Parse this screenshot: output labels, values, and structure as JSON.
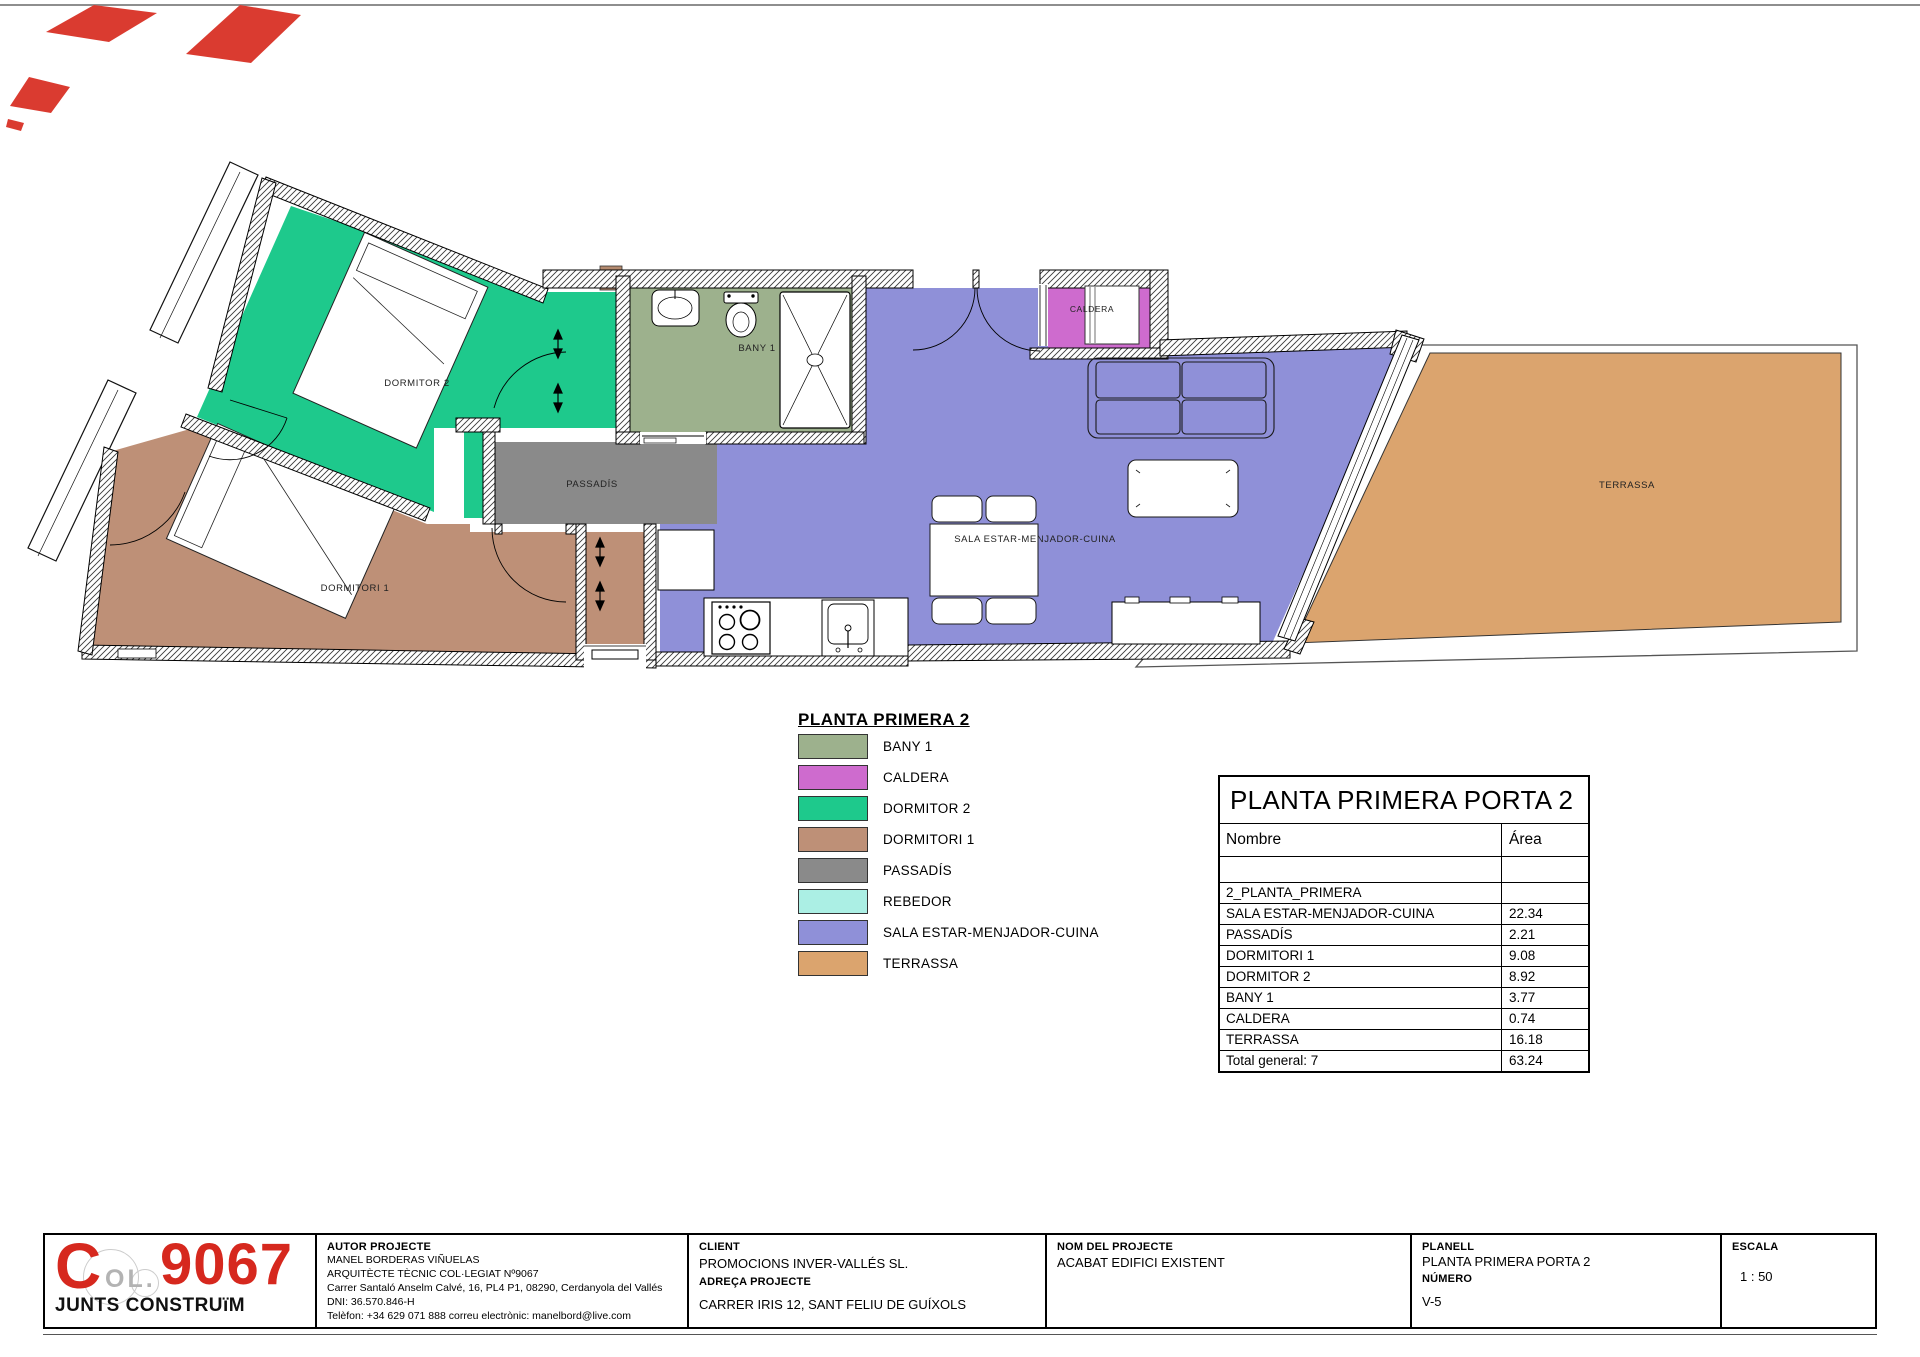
{
  "plan": {
    "labels": {
      "dormitor2": "DORMITOR 2",
      "dormitori1": "DORMITORI 1",
      "passadis": "PASSADÍS",
      "bany1": "BANY 1",
      "caldera": "CALDERA",
      "sala": "SALA ESTAR-MENJADOR-CUINA",
      "terrassa": "TERRASSA"
    }
  },
  "legend": {
    "title": "PLANTA PRIMERA 2",
    "items": [
      {
        "label": "BANY 1",
        "color": "#9DB18D"
      },
      {
        "label": "CALDERA",
        "color": "#CE6BCE"
      },
      {
        "label": "DORMITOR 2",
        "color": "#1EC98C"
      },
      {
        "label": "DORMITORI 1",
        "color": "#BE9077"
      },
      {
        "label": "PASSADÍS",
        "color": "#8A8A8A"
      },
      {
        "label": "REBEDOR",
        "color": "#ABEFE4"
      },
      {
        "label": "SALA ESTAR-MENJADOR-CUINA",
        "color": "#8F90D8"
      },
      {
        "label": "TERRASSA",
        "color": "#DBA46E"
      }
    ]
  },
  "area_table": {
    "title": "PLANTA PRIMERA PORTA 2",
    "col_name": "Nombre",
    "col_area": "Área",
    "rows": [
      {
        "name": "",
        "area": ""
      },
      {
        "name": "2_PLANTA_PRIMERA",
        "area": ""
      },
      {
        "name": "SALA ESTAR-MENJADOR-CUINA",
        "area": "22.34"
      },
      {
        "name": "PASSADÍS",
        "area": "2.21"
      },
      {
        "name": "DORMITORI 1",
        "area": "9.08"
      },
      {
        "name": "DORMITOR 2",
        "area": "8.92"
      },
      {
        "name": "BANY 1",
        "area": "3.77"
      },
      {
        "name": "CALDERA",
        "area": "0.74"
      },
      {
        "name": "TERRASSA",
        "area": "16.18"
      },
      {
        "name": "Total general: 7",
        "area": "63.24"
      }
    ]
  },
  "titleblock": {
    "logo": {
      "c": "C",
      "ol": "OL.",
      "number": "9067",
      "tagline": "JUNTS CONSTRUïM"
    },
    "autor": {
      "header": "AUTOR PROJECTE",
      "line1": "MANEL BORDERAS VIÑUELAS",
      "line2": "ARQUITÈCTE TÈCNIC COL·LEGIAT Nº9067",
      "line3": "Carrer Santaló Anselm Calvé, 16, PL4 P1, 08290, Cerdanyola del Vallés",
      "line4": "DNI: 36.570.846-H",
      "line5": "Telèfon: +34 629 071 888 correu electrònic: manelbord@live.com"
    },
    "client": {
      "header": "CLIENT",
      "name": "PROMOCIONS INVER-VALLÉS SL.",
      "addr_header": "ADREÇA PROJECTE",
      "addr": "CARRER IRIS 12, SANT FELIU DE GUÍXOLS"
    },
    "nom": {
      "header": "NOM DEL PROJECTE",
      "value": "ACABAT EDIFICI EXISTENT"
    },
    "planell": {
      "header": "PLANELL",
      "value": "PLANTA PRIMERA PORTA 2",
      "num_header": "NÚMERO",
      "num": "V-5"
    },
    "escala": {
      "header": "ESCALA",
      "value": "1 : 50"
    }
  }
}
